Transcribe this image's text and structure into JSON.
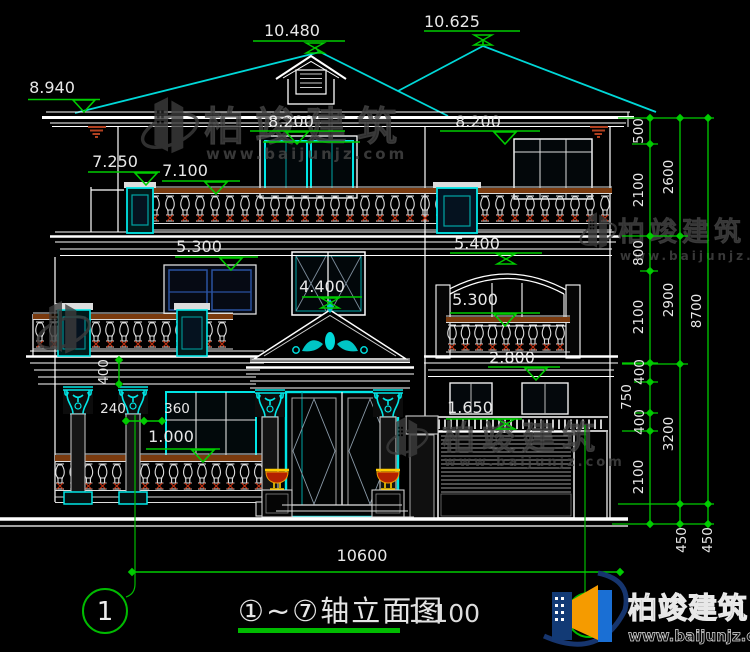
{
  "watermark": {
    "brand": "柏竣建筑",
    "url": "www.baijunjz.com"
  },
  "footer": {
    "axis_bubble": "1",
    "title": "①~⑦轴立面图",
    "scale": "1:100"
  },
  "elevations": {
    "ridge_left": "10.480",
    "ridge_right": "10.625",
    "eave_left": "8.940",
    "floor3_left": "8.200",
    "floor3_right": "8.200",
    "parapet_post": "7.250",
    "parapet_rail": "7.100",
    "floor2_left": "5.300",
    "floor2_right_upper": "5.400",
    "floor2_right": "5.300",
    "pediment_apex": "4.400",
    "window_head_right": "2.800",
    "garage_lintel": "1.650",
    "porch_rail": "1.000"
  },
  "dims": {
    "overall_width": "10600",
    "overall_height": "8700",
    "right_inner": [
      "500",
      "2100",
      "800",
      "2100",
      "400",
      "750",
      "400",
      "2100"
    ],
    "right_middle": [
      "2600",
      "2900",
      "3200"
    ],
    "base_offsets": [
      "450",
      "450"
    ],
    "column_width": "240",
    "column_gap": "360",
    "beam_depth": "400"
  },
  "colors": {
    "background": "#000000",
    "linework": "#ffffff",
    "trim_cyan": "#00e5e5",
    "dimension_green": "#00cc00",
    "rail_brown": "#7a3a0e",
    "baluster_red": "#c03010",
    "bracket_red": "#b04020",
    "urn_red": "#b32000",
    "urn_gold": "#ffcc00",
    "logo_orange": "#f59b00",
    "logo_blue": "#1a6fd4",
    "watermark_gray": "#3f3f3f"
  }
}
